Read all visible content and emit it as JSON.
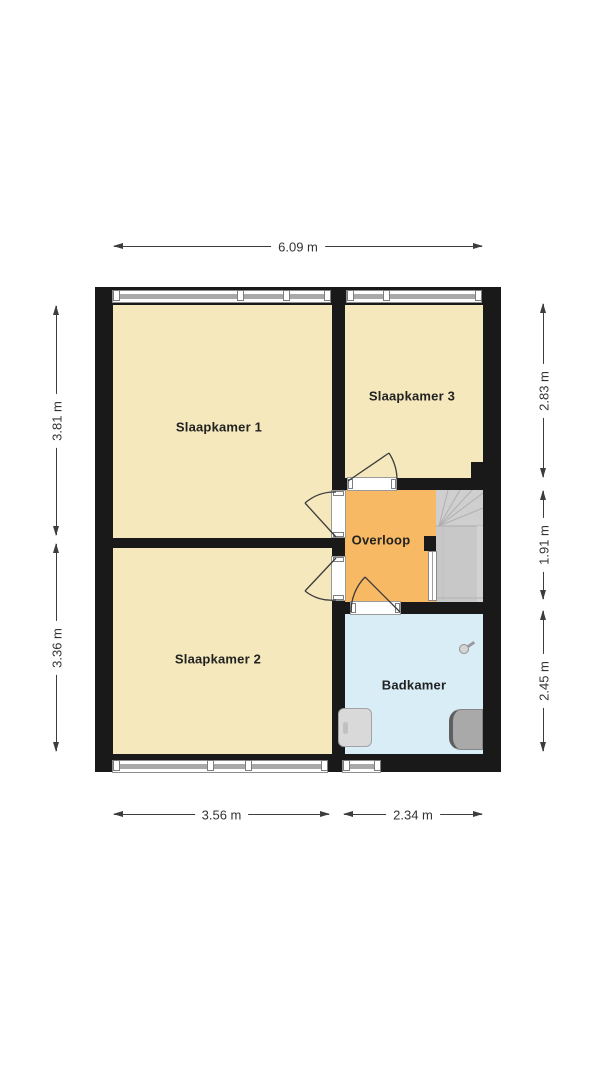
{
  "floor_plan": {
    "rooms": {
      "slaapkamer1": "Slaapkamer 1",
      "slaapkamer2": "Slaapkamer 2",
      "slaapkamer3": "Slaapkamer 3",
      "overloop": "Overloop",
      "badkamer": "Badkamer"
    },
    "dimensions": {
      "top_width": "6.09 m",
      "left_upper": "3.81 m",
      "left_lower": "3.36 m",
      "right_upper": "2.83 m",
      "right_middle": "1.91 m",
      "right_lower": "2.45 m",
      "bottom_left": "3.56 m",
      "bottom_right": "2.34 m"
    },
    "colors": {
      "bedroom_fill": "#F5E8BC",
      "landing_fill": "#F7B963",
      "bathroom_fill": "#D8EDF5",
      "stairs_fill": "#C8C8C8",
      "wall": "#191919"
    }
  }
}
